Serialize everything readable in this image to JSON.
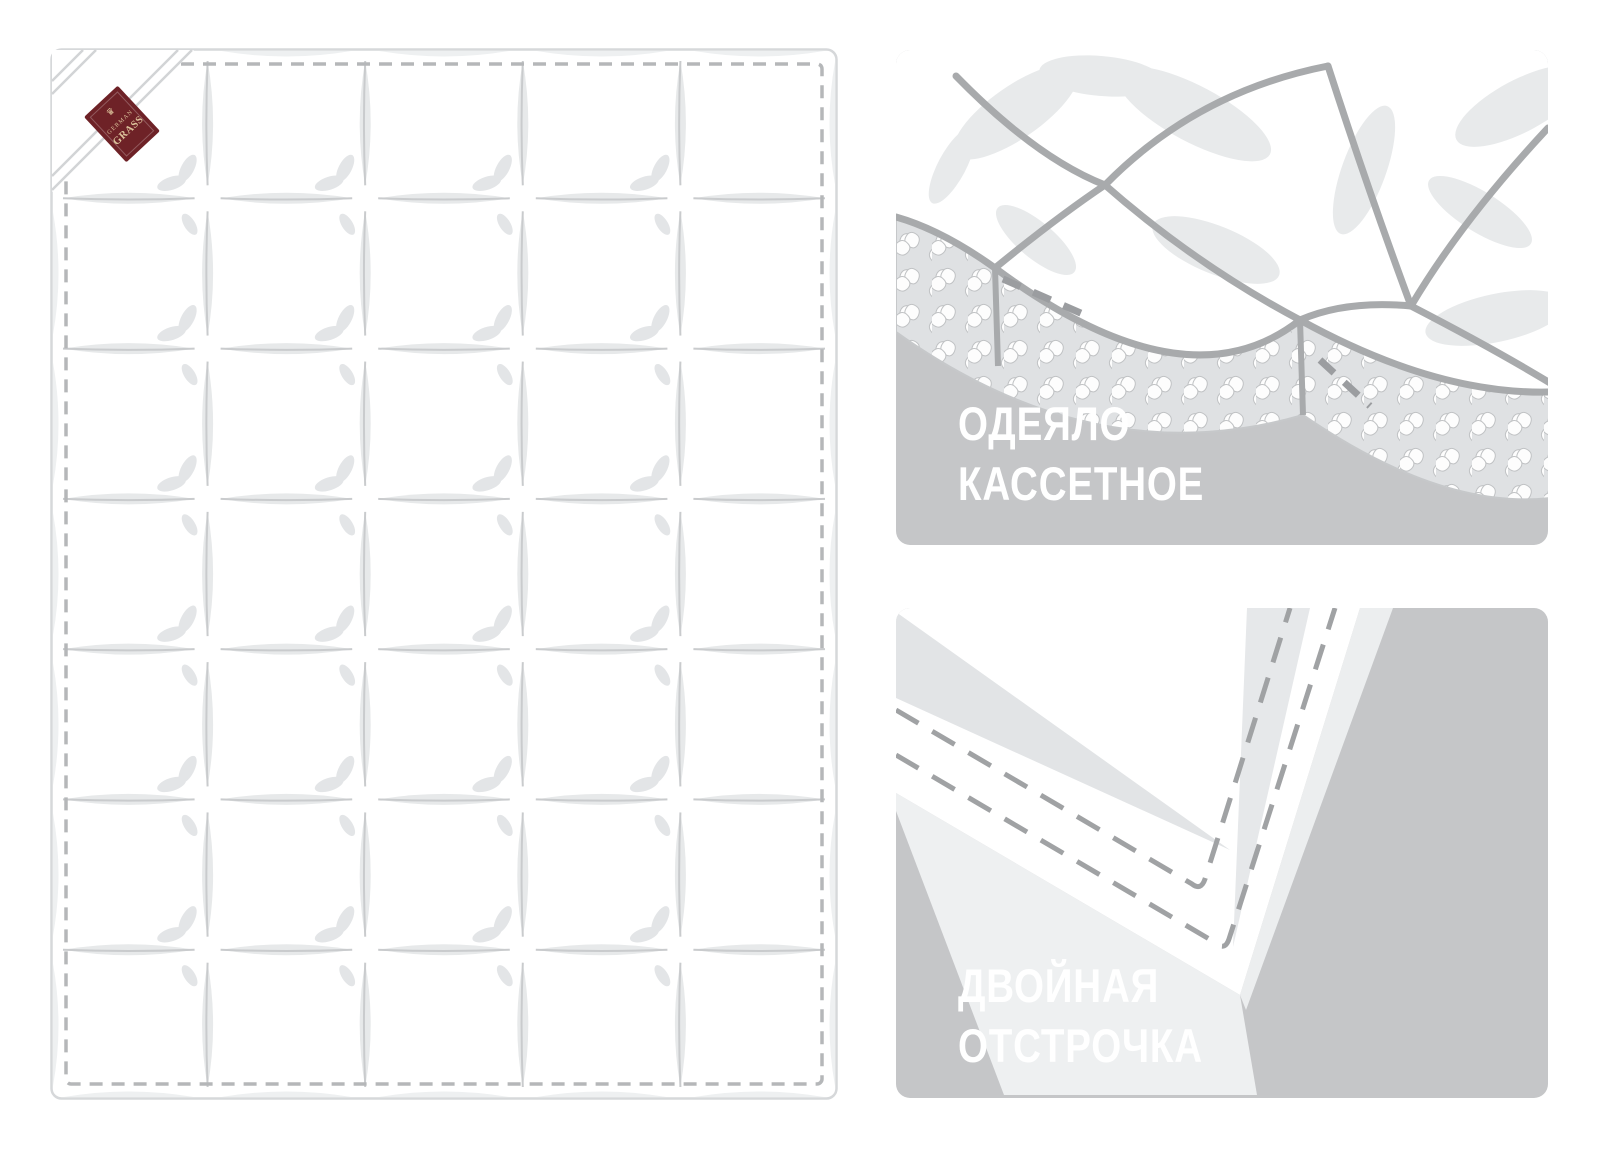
{
  "brand_label": {
    "crown": "♛",
    "line1": "GERMAN",
    "line2": "GRASS",
    "bg_color": "#6e2227",
    "text_color": "#ddc49c"
  },
  "quilt": {
    "columns": 5,
    "rows": 7,
    "border_style": "dashed-stitch"
  },
  "features": [
    {
      "id": "cassette",
      "line1": "ОДЕЯЛО",
      "line2": "КАССЕТНОЕ"
    },
    {
      "id": "double-stitch",
      "line1": "ДВОЙНАЯ",
      "line2": "ОТСТРОЧКА"
    }
  ],
  "colors": {
    "page_bg": "#ffffff",
    "card_bg": "#c5c6c8",
    "feature_text": "#ffffff",
    "illustration_line": "#a8aaac",
    "lens_gray": "#e7e9ea",
    "petal_gray": "#e3e5e7",
    "seam_line": "#c9cbcd",
    "stitch_gray": "#b5b7b9",
    "quilt_outline": "#d6d8da",
    "fold_line": "#d2d4d6",
    "dash_stitch_card": "#a0a2a4",
    "pattern_base": "#dfe1e3"
  }
}
